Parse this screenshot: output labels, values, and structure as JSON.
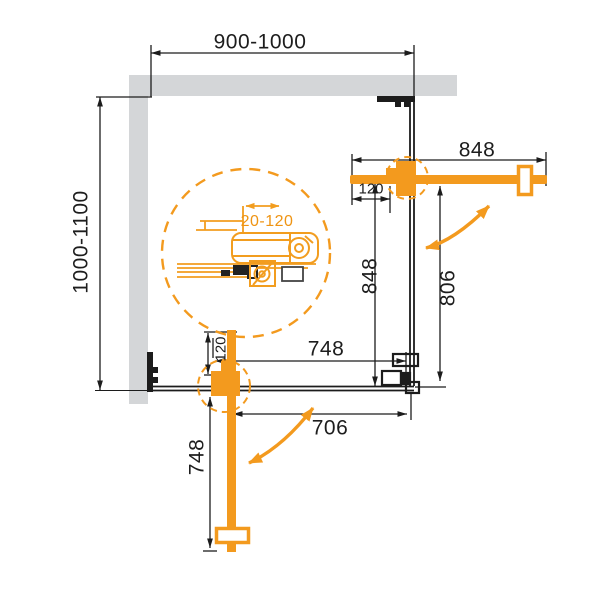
{
  "drawing": {
    "labels": {
      "width_range": "900-1000",
      "depth_range": "1000-1100",
      "door_width_top": "848",
      "glass_height_right": "848",
      "door_swing_right": "806",
      "glass_width_bottom": "748",
      "door_swing_bottom": "706",
      "door_length_bottom": "748",
      "wall_offset_top": "120",
      "wall_offset_bottom": "120",
      "adjustment_range": "20-120"
    },
    "colors": {
      "accent_orange": "#F39A1E",
      "wall_gray": "#D4D6D8",
      "line_black": "#1C1C1C"
    }
  }
}
